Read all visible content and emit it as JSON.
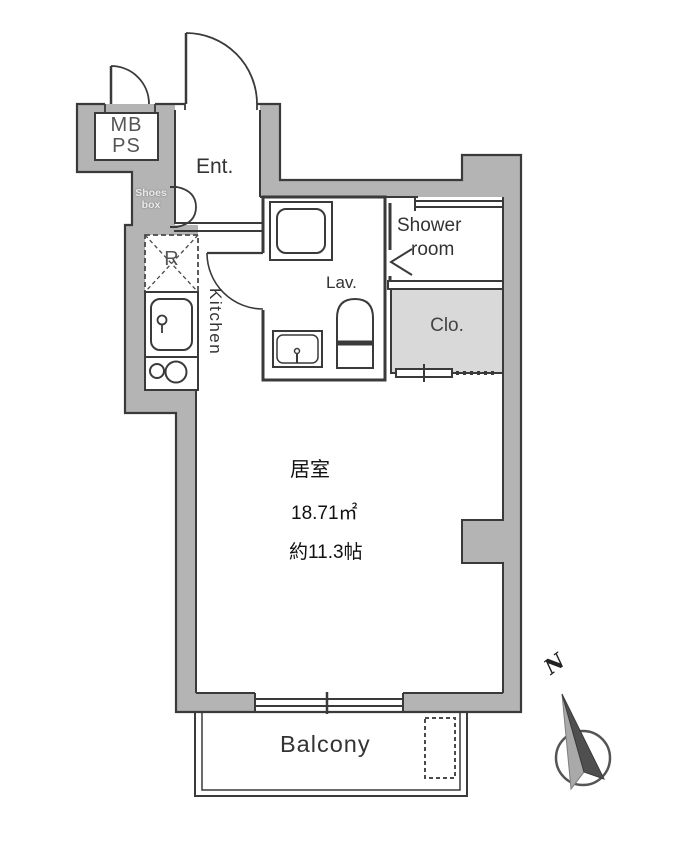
{
  "floor_plan": {
    "rooms": {
      "mb_ps": {
        "line1": "MB",
        "line2": "PS"
      },
      "entrance": {
        "label": "Ent."
      },
      "shoes_box": {
        "line1": "Shoes",
        "line2": "box"
      },
      "refrigerator_space": {
        "label": "R"
      },
      "kitchen": {
        "label": "Kitchen"
      },
      "lavatory": {
        "label": "Lav."
      },
      "shower_room": {
        "line1": "Shower",
        "line2": "room"
      },
      "closet": {
        "label": "Clo."
      },
      "living_room": {
        "name": "居室",
        "area_sqm": "18.71㎡",
        "area_tatami": "約11.3帖"
      },
      "balcony": {
        "label": "Balcony"
      }
    },
    "compass": {
      "north_label": "N"
    },
    "colors": {
      "wall_fill": "#b4b4b4",
      "closet_fill": "#d9d9d9",
      "line": "#3a3a3a",
      "background": "#ffffff"
    }
  }
}
